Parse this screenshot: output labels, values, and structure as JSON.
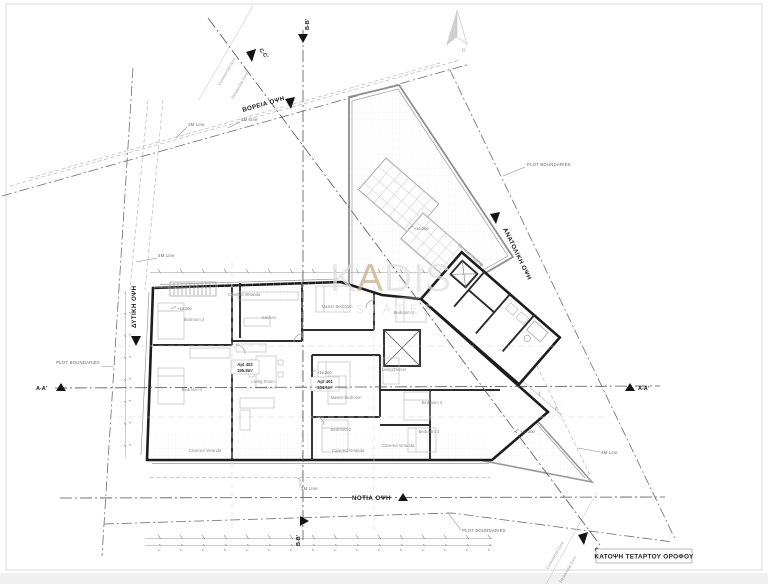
{
  "drawing": {
    "title": "ΚΑΤΟΨΗ ΤΕΤΑΡΤΟΥ ΟΡΟΦΟΥ"
  },
  "watermark": {
    "part1": "K",
    "accent": "A",
    "part2": "DIS",
    "subtitle": "ESTATES",
    "accent_color": "#c7ac80",
    "gray_color": "#dedede"
  },
  "compass": {
    "letter": "B"
  },
  "elevations": {
    "north": "ΒΟΡΕΙΑ ΟΨΗ",
    "south": "ΝΟΤΙΑ ΟΨΗ",
    "west": "ΔΥΤΙΚΗ ΟΨΗ",
    "east": "ΑΝΑΤΟΛΙΚΗ ΟΨΗ"
  },
  "sections": {
    "aa": "A-A'",
    "bb": "B-B'",
    "cc": "C-C'"
  },
  "site": {
    "plot_boundaries": "PLOT BOUNDARIES",
    "commercial_zone": "Commercial Zone",
    "residential_zone": "Residential Zone",
    "line_3m": "3M Line",
    "line_4m": "4M Line"
  },
  "levels": {
    "floor": "+15.200"
  },
  "apartments": {
    "apt402": {
      "name": "Apt 402",
      "area": "195.8m²"
    },
    "apt401": {
      "name": "Apt 401",
      "area": "134.6m²"
    }
  },
  "rooms": {
    "covered_veranda": "Covered Veranda",
    "master_bedroom": "Master Bedroom",
    "bedroom2": "Bedroom 2",
    "bedroom3": "Bedroom 3",
    "bedroom4": "Bedroom 4",
    "kitchen": "Kitchen",
    "living_room": "Living Room",
    "living_dinner": "Living/Dinner"
  }
}
